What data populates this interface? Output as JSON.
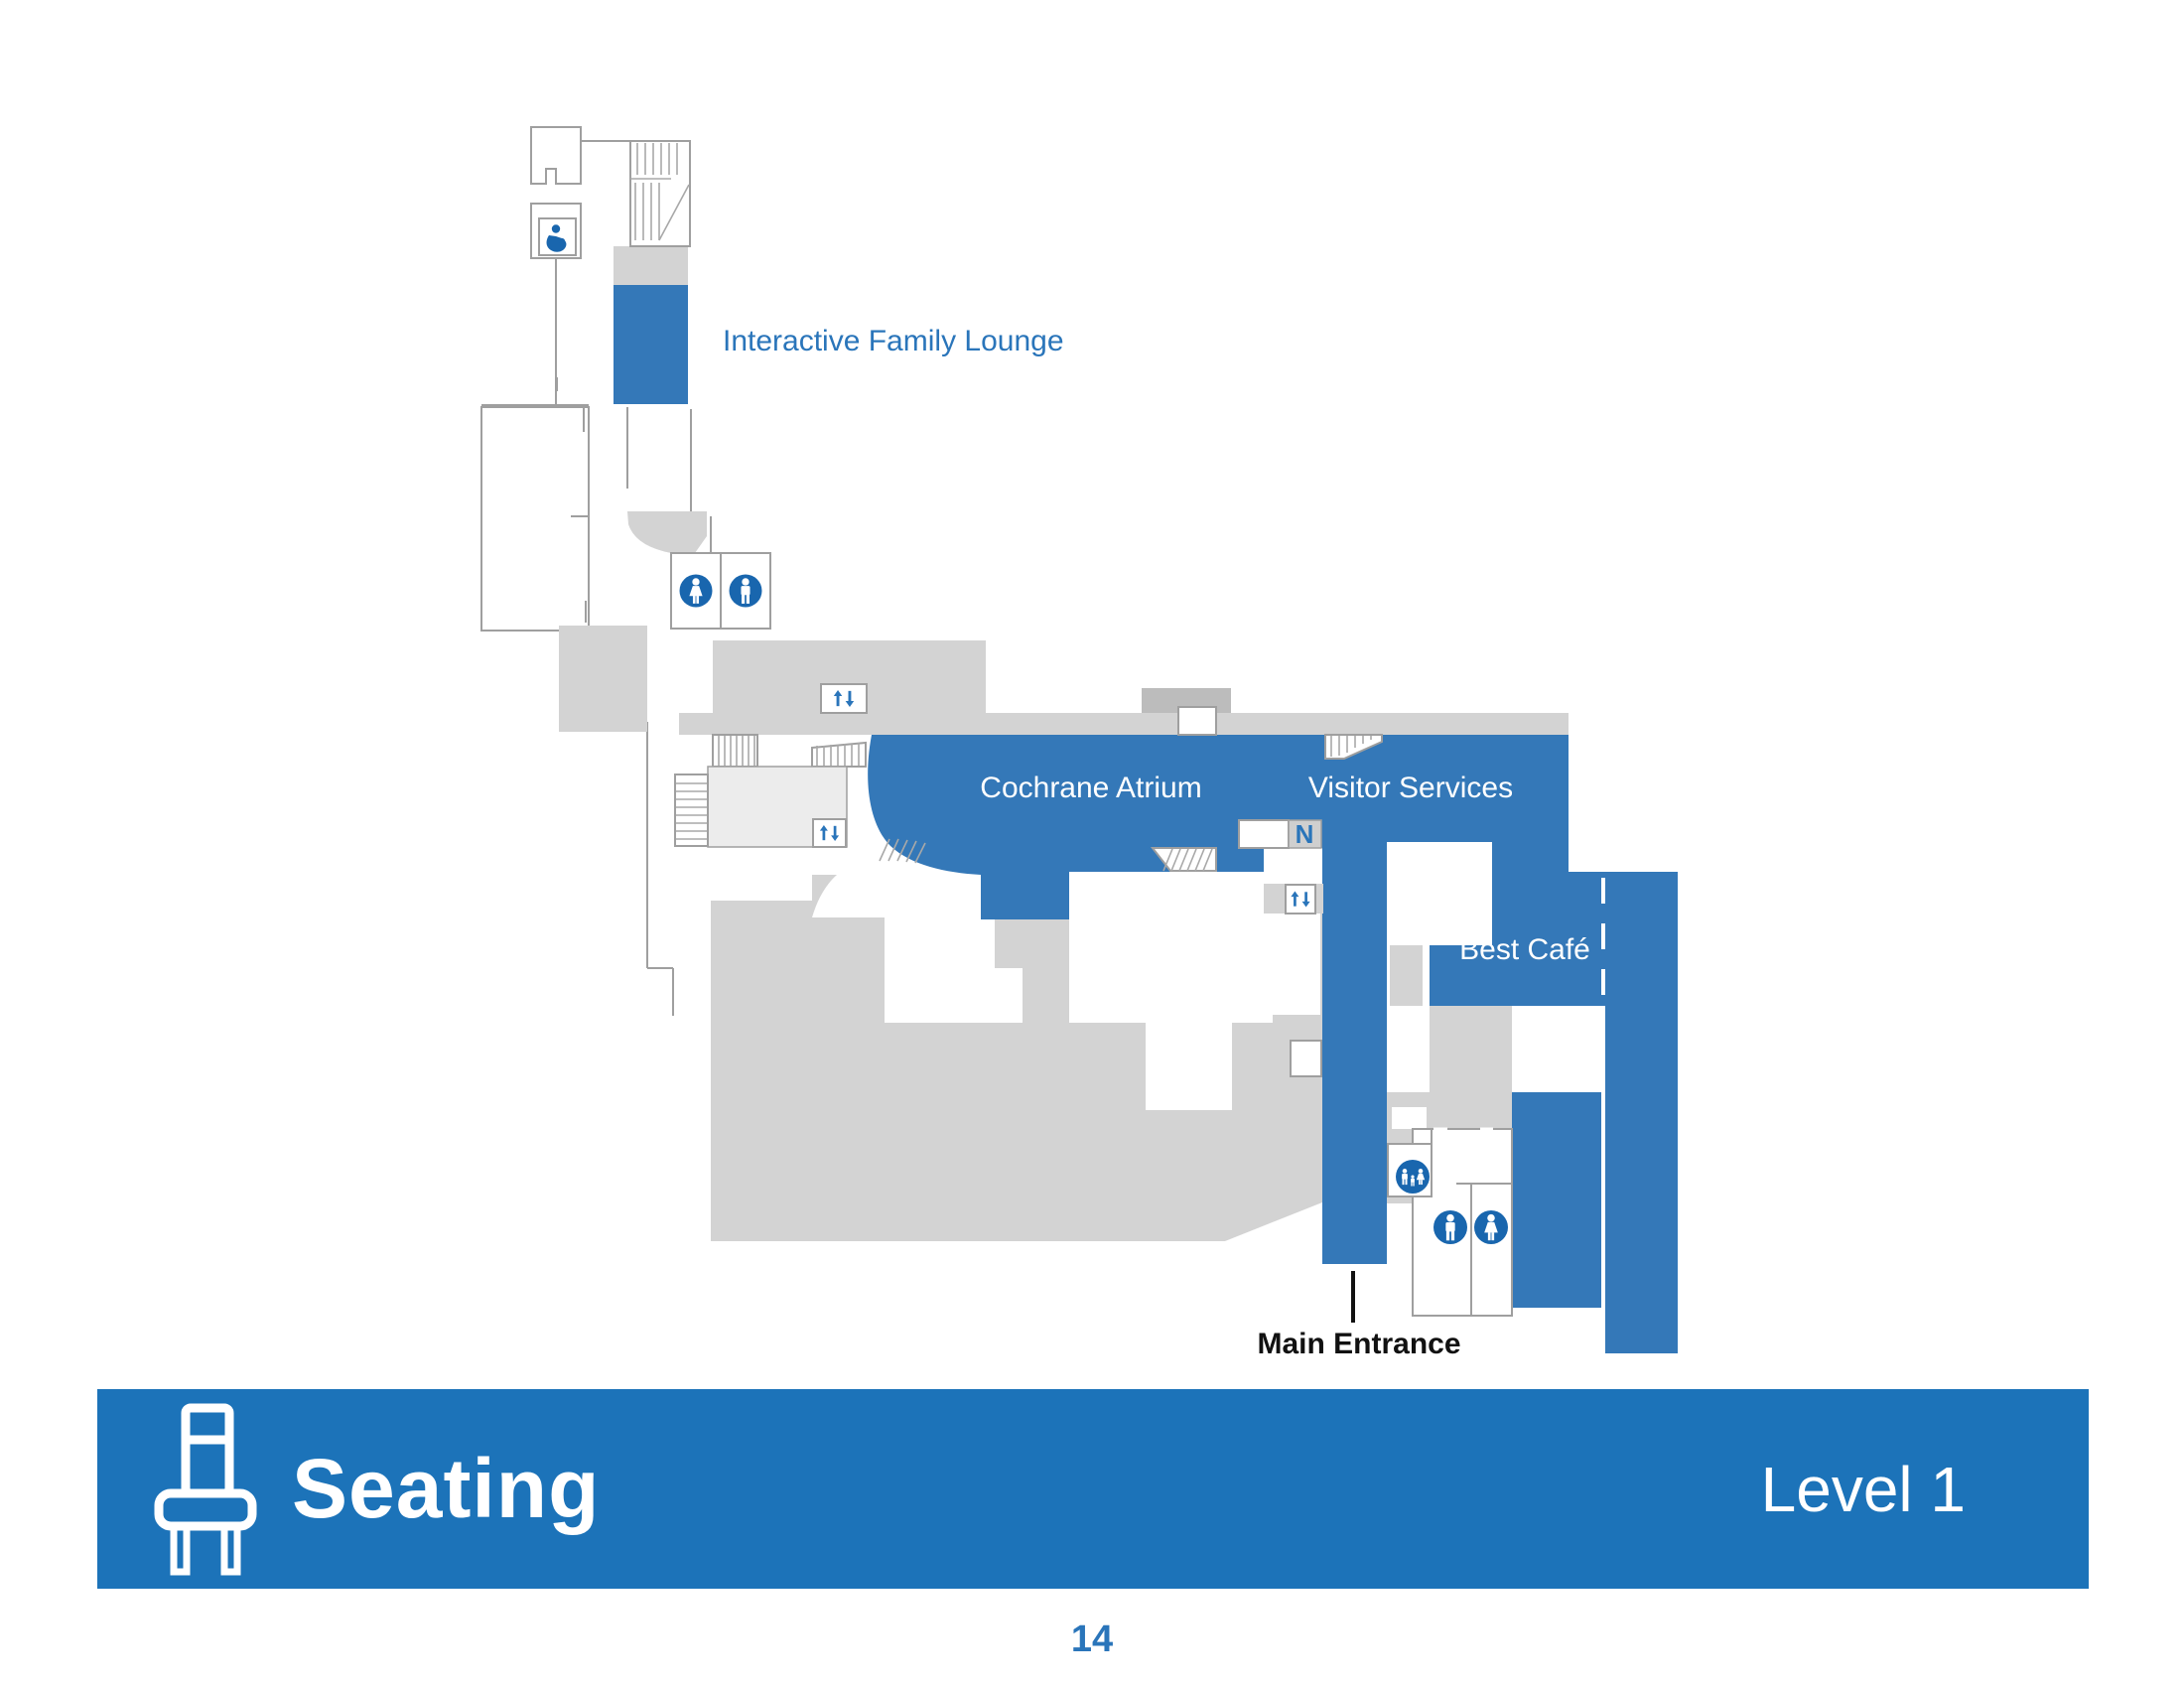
{
  "map": {
    "labels": {
      "family_lounge": "Interactive Family Lounge",
      "atrium": "Cochrane Atrium",
      "visitor_services": "Visitor Services",
      "cafe": "Best Café",
      "main_entrance": "Main Entrance"
    },
    "icons": [
      "nursing-room-icon",
      "women-restroom-icon",
      "men-restroom-icon",
      "family-restroom-icon",
      "elevator-icon",
      "escalator-icon",
      "stairs-icon"
    ],
    "escalator_glyph": "N"
  },
  "banner": {
    "title": "Seating",
    "level": "Level 1",
    "icon": "chair-icon"
  },
  "page": {
    "number": "14"
  },
  "colors": {
    "map_blue": "#3478b8",
    "banner_blue": "#1c73b9",
    "icon_blue": "#1966ae",
    "label_blue": "#2a75ba",
    "gray_light": "#d3d3d3",
    "gray_lighter": "#ececec",
    "gray_dark": "#bcbcbc",
    "wall": "#9f9f9f",
    "entrance_black": "#111111"
  }
}
